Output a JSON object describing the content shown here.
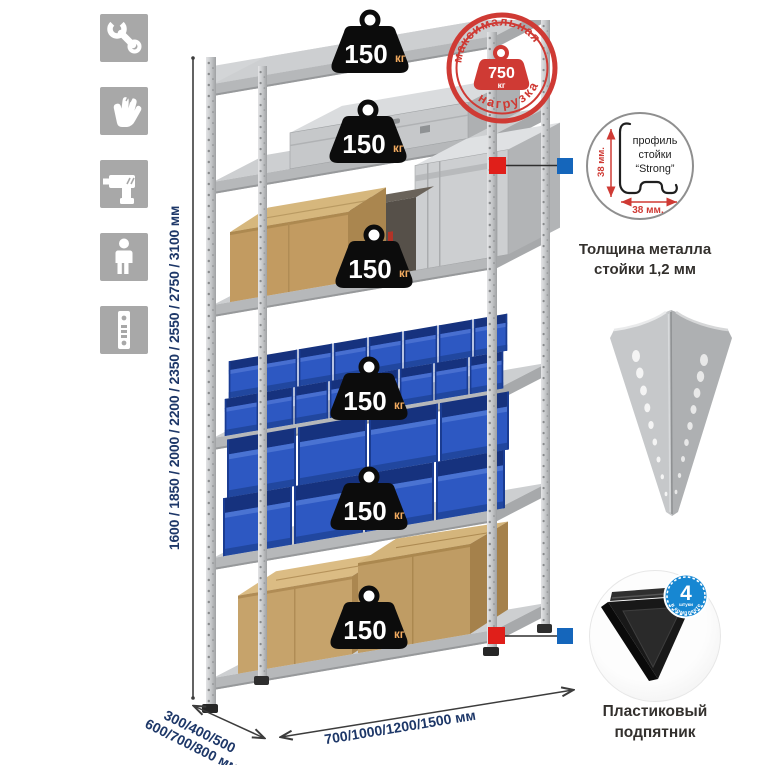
{
  "page": {
    "background": "#ffffff"
  },
  "colors": {
    "accent_navy": "#1d3768",
    "stamp_red": "#cf3a34",
    "weight_black": "#0c0c0c",
    "kg_orange": "#f2ab60",
    "bin_blue": "#2d58c2",
    "metal_gray": "#cdcfd1",
    "icon_gray": "#a8a8a8",
    "connector_red": "#e01f1a",
    "connector_blue": "#1566bb",
    "badge_blue": "#1787d2"
  },
  "sidebar": {
    "icons": [
      {
        "name": "wrench-icon"
      },
      {
        "name": "gloves-icon"
      },
      {
        "name": "drill-icon"
      },
      {
        "name": "person-icon"
      },
      {
        "name": "post-strip-icon"
      }
    ]
  },
  "dimensions": {
    "height_label": "1600 / 1850 / 2000 / 2200 / 2350 / 2550 / 2750 / 3100 мм",
    "depth_label_line1": "300/400/500",
    "depth_label_line2": "600/700/800 мм",
    "width_label": "700/1000/1200/1500 мм"
  },
  "rack": {
    "shelf_count": 6,
    "load_value": "150",
    "load_unit": "кг"
  },
  "stamp": {
    "arc_top": "максимальная",
    "arc_bottom": "нагрузка",
    "value": "750",
    "unit": "кг"
  },
  "profile_detail": {
    "line1": "профиль",
    "line2": "стойки",
    "line3": "“Strong”",
    "dim_v": "38 мм.",
    "dim_h": "38 мм.",
    "caption_line1": "Толщина металла",
    "caption_line2": "стойки 1,2 мм"
  },
  "foot_detail": {
    "badge_value": "4",
    "badge_small": "штуки",
    "badge_arc": "в комплекте",
    "caption_line1": "Пластиковый",
    "caption_line2": "подпятник"
  }
}
